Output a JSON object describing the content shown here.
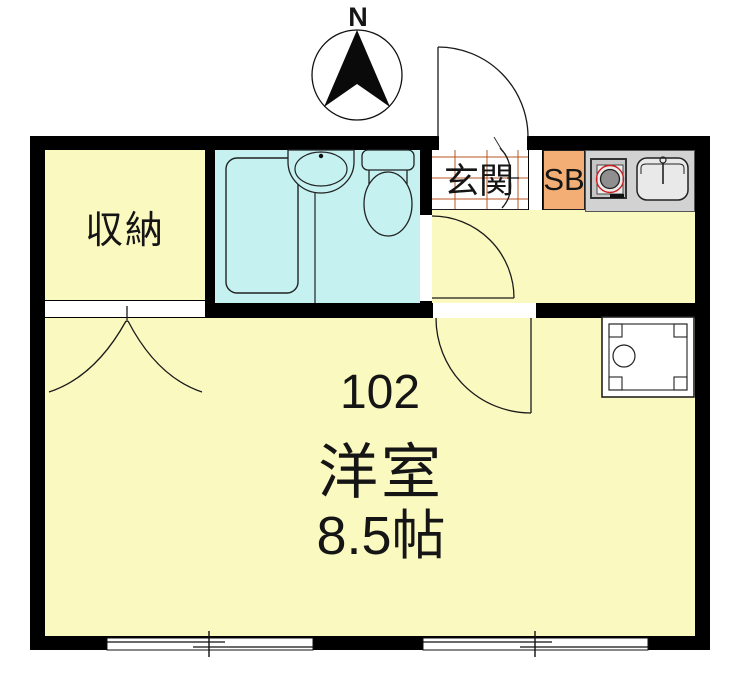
{
  "compass": {
    "label": "N"
  },
  "rooms": {
    "storage": {
      "label": "収納"
    },
    "entrance": {
      "label": "玄関"
    },
    "shoe_box": {
      "label": "SB"
    },
    "main_room": {
      "number": "102",
      "type": "洋室",
      "size": "8.5帖"
    }
  },
  "fixture_icons": [
    "north-arrow-icon",
    "bathtub-icon",
    "washbasin-icon",
    "toilet-icon",
    "stove-burner-icon",
    "kitchen-sink-icon",
    "washing-machine-pan-icon",
    "door-swing-arc",
    "double-door-swing-arc",
    "sliding-window-symbol"
  ],
  "colors": {
    "room_yellow": "#FAF9C0",
    "bathroom_cyan": "#C5F1F1",
    "shoe_box_orange": "#F2AE74",
    "kitchen_gray": "#D2D2D2",
    "wall_black": "#000000",
    "entry_tile_grid": "#B85522",
    "stove_ring_red": "#CC2222"
  }
}
